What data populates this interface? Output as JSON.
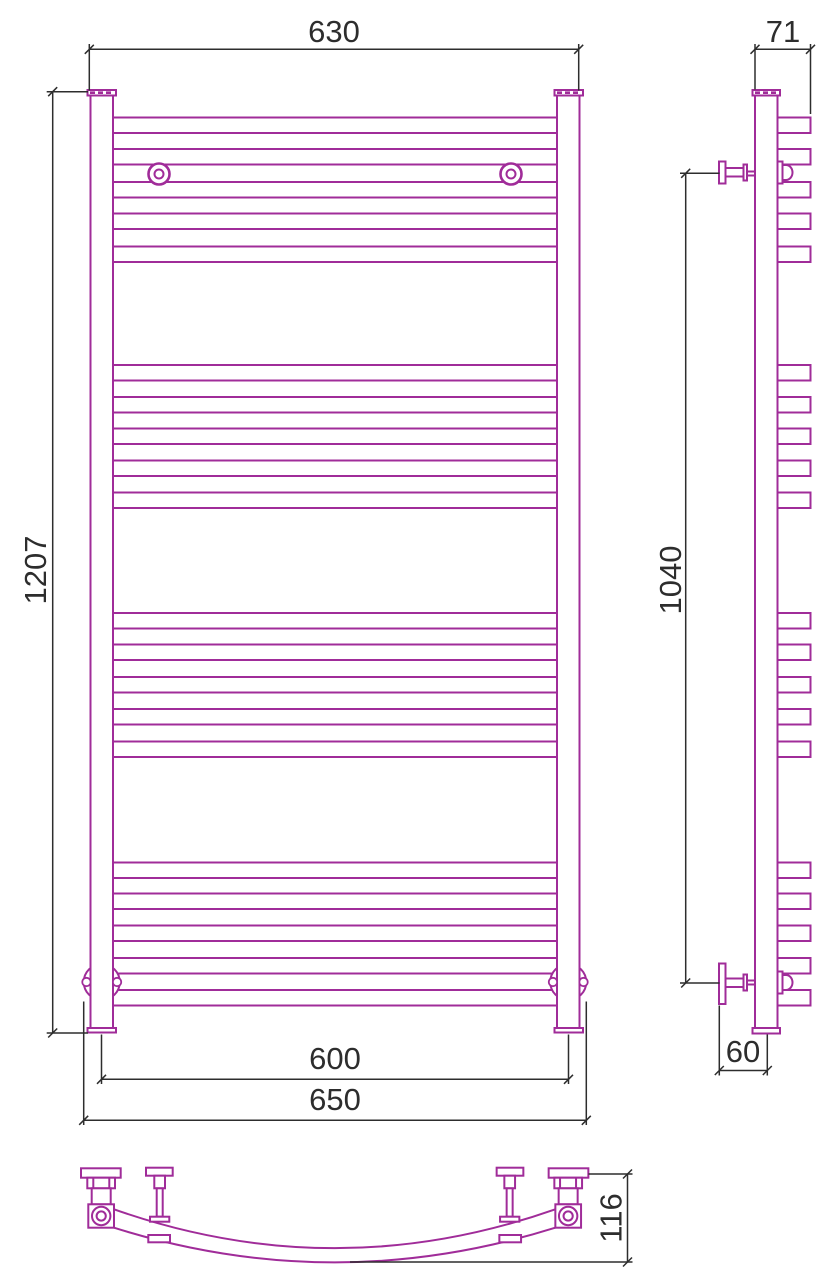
{
  "drawing": {
    "subject": "ladder-towel-radiator-technical-drawing",
    "line_color": "#a02c99",
    "dim_color": "#2d2d2d",
    "background": "#ffffff",
    "views": {
      "front": "front-view",
      "side": "side-view",
      "bottom": "bottom-view"
    },
    "dimensions": {
      "front_width_top": "630",
      "overall_height": "1207",
      "axis_width": "600",
      "overall_width": "650",
      "depth": "71",
      "bracket_span": "1040",
      "wall_offset": "60",
      "bottom_depth": "116"
    },
    "geometry": {
      "tube_y": [
        117.5,
        149,
        182,
        213.5,
        246.5,
        365,
        397,
        428.5,
        460.5,
        492.5,
        613,
        644.5,
        677,
        709,
        741.5,
        862.5,
        893.5,
        925.5,
        958,
        990
      ],
      "front_tube": {
        "x": 113,
        "w": 444,
        "h": 15.5
      },
      "side_tube": {
        "x": 777.5,
        "w": 33,
        "h": 15.5
      }
    }
  }
}
